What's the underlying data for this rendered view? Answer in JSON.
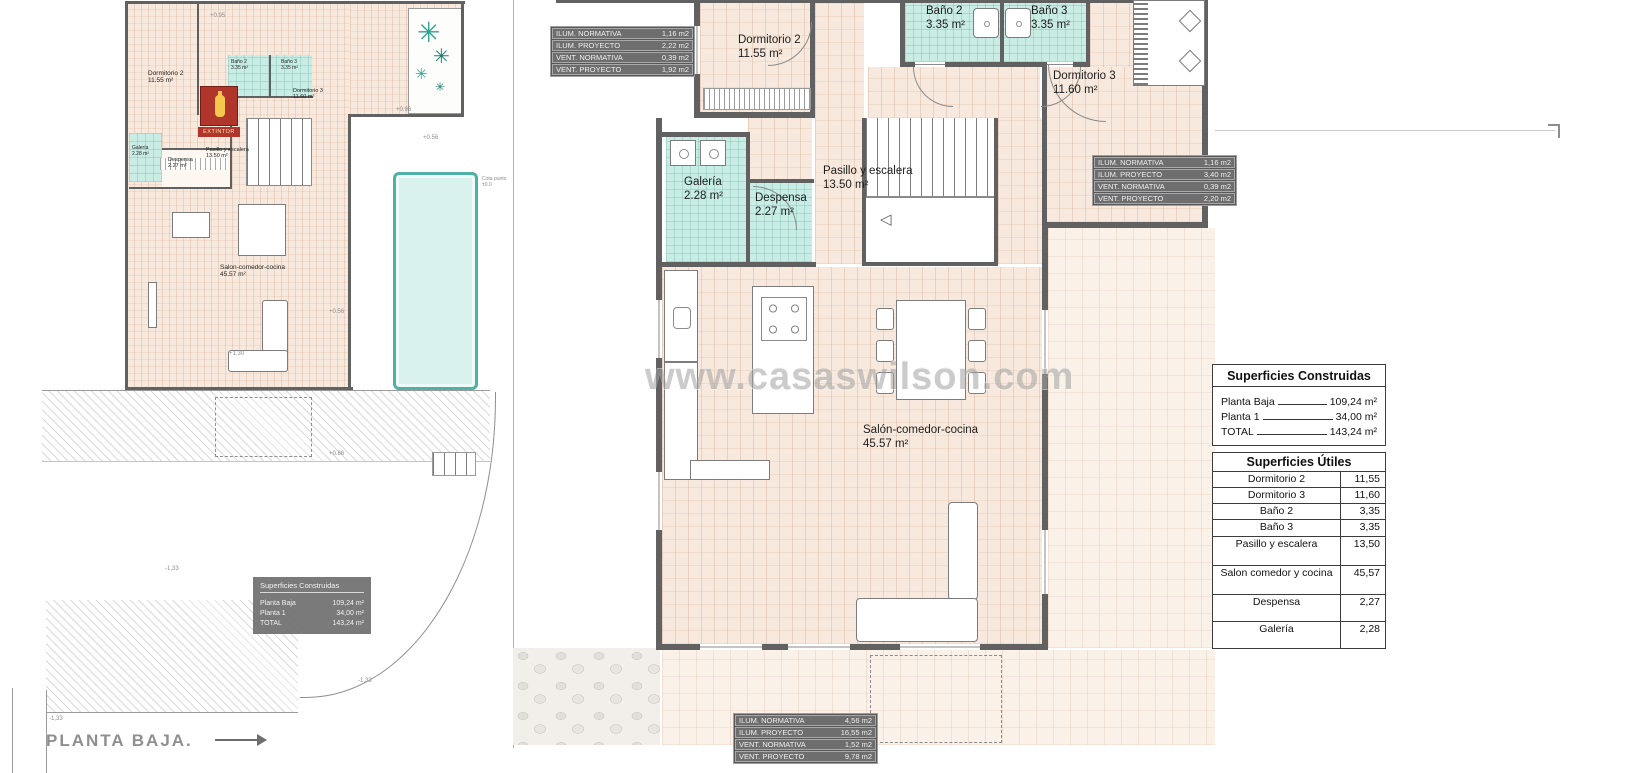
{
  "sheet": {
    "footer_title": "PLANTA BAJA.",
    "watermark": "www.casaswilson.com"
  },
  "rooms_main": {
    "dormitorio2": {
      "name": "Dormitorio 2",
      "area": "11.55 m²"
    },
    "bano2": {
      "name": "Baño 2",
      "area": "3.35 m²"
    },
    "bano3": {
      "name": "Baño 3",
      "area": "3.35 m²"
    },
    "dormitorio3": {
      "name": "Dormitorio 3",
      "area": "11.60 m²"
    },
    "galeria": {
      "name": "Galería",
      "area": "2.28 m²"
    },
    "despensa": {
      "name": "Despensa",
      "area": "2.27 m²"
    },
    "pasillo": {
      "name": "Pasillo y escalera",
      "area": "13.50 m²"
    },
    "salon": {
      "name": "Salón-comedor-cocina",
      "area": "45.57 m²"
    }
  },
  "rooms_left": {
    "dormitorio2": {
      "name": "Dormitorio 2",
      "area": "11.55 m²"
    },
    "bano2": {
      "name": "Baño 2",
      "area": "3.35 m²"
    },
    "bano3": {
      "name": "Baño 3",
      "area": "3.35 m²"
    },
    "dormitorio3": {
      "name": "Dormitorio 3",
      "area": "11.60 m²"
    },
    "galeria": {
      "name": "Galería",
      "area": "2.28 m²"
    },
    "despensa": {
      "name": "Despensa",
      "area": "2.27 m²"
    },
    "pasillo": {
      "name": "Pasillo y escalera",
      "area": "13.50 m²"
    },
    "salon": {
      "name": "Salon-comedor-cocina",
      "area": "45.57 m²"
    },
    "extintor": "EXTINTOR"
  },
  "annotations": {
    "cota": "Cota punto ±0.0",
    "levels": [
      "+0.95",
      "+0.96",
      "+0.56",
      "+0.56",
      "+0.86",
      "+1.30",
      "-1,33",
      "-1,33",
      "-1,33"
    ]
  },
  "env_tables": {
    "top": {
      "rows": [
        {
          "label": "ILUM. NORMATIVA",
          "value": "1,16 m2"
        },
        {
          "label": "ILUM. PROYECTO",
          "value": "2,22 m2"
        },
        {
          "label": "VENT. NORMATIVA",
          "value": "0,39 m2"
        },
        {
          "label": "VENT. PROYECTO",
          "value": "1,92 m2"
        }
      ]
    },
    "right": {
      "rows": [
        {
          "label": "ILUM. NORMATIVA",
          "value": "1,16 m2"
        },
        {
          "label": "ILUM. PROYECTO",
          "value": "3,40 m2"
        },
        {
          "label": "VENT. NORMATIVA",
          "value": "0,39 m2"
        },
        {
          "label": "VENT. PROYECTO",
          "value": "2,20 m2"
        }
      ]
    },
    "bottom": {
      "rows": [
        {
          "label": "ILUM. NORMATIVA",
          "value": "4,56 m2"
        },
        {
          "label": "ILUM. PROYECTO",
          "value": "16,55 m2"
        },
        {
          "label": "VENT. NORMATIVA",
          "value": "1,52 m2"
        },
        {
          "label": "VENT. PROYECTO",
          "value": "9,78 m2"
        }
      ]
    }
  },
  "superficies_construidas": {
    "title": "Superficies Construidas",
    "rows": [
      {
        "label": "Planta Baja",
        "value": "109,24 m²"
      },
      {
        "label": "Planta 1",
        "value": "34,00 m²"
      },
      {
        "label": "TOTAL",
        "value": "143,24 m²"
      }
    ]
  },
  "superficies_utiles": {
    "title": "Superficies Útiles",
    "rows": [
      {
        "label": "Dormitorio 2",
        "value": "11,55"
      },
      {
        "label": "Dormitorio 3",
        "value": "11,60"
      },
      {
        "label": "Baño 2",
        "value": "3,35"
      },
      {
        "label": "Baño 3",
        "value": "3,35"
      },
      {
        "label": "Pasillo y escalera",
        "value": "13,50"
      },
      {
        "label": "Salon comedor y cocina",
        "value": "45,57"
      },
      {
        "label": "Despensa",
        "value": "2,27"
      },
      {
        "label": "Galería",
        "value": "2,28"
      }
    ]
  }
}
